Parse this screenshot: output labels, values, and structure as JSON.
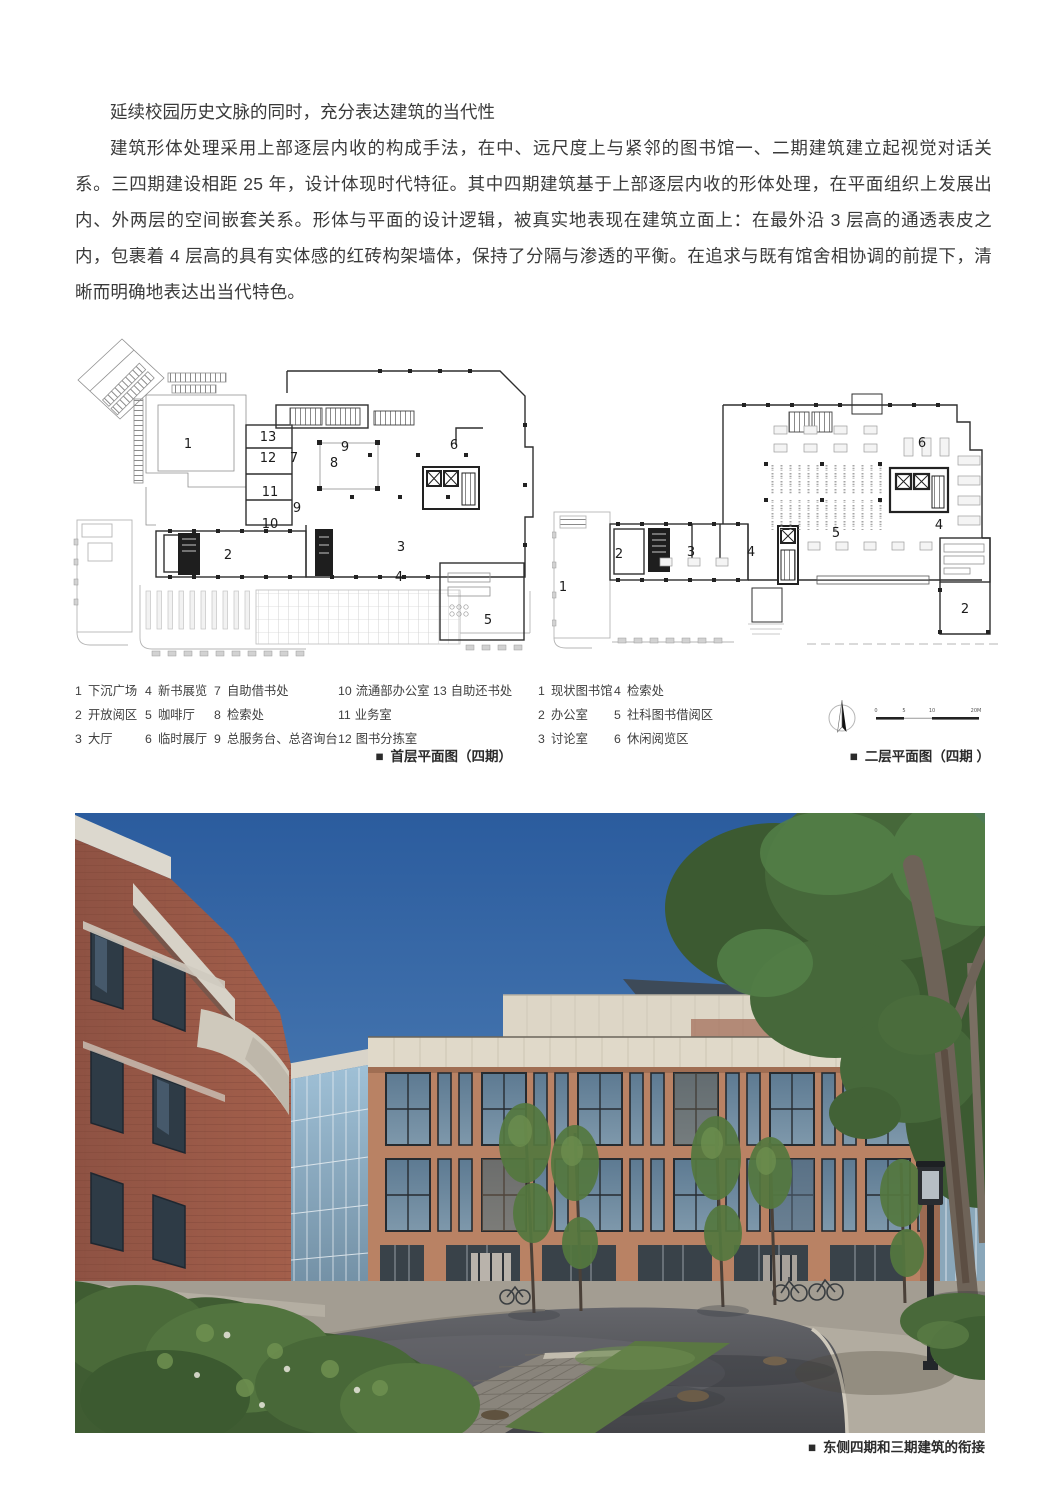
{
  "article": {
    "heading": "延续校园历史文脉的同时，充分表达建筑的当代性",
    "paragraph": "建筑形体处理采用上部逐层内收的构成手法，在中、远尺度上与紧邻的图书馆一、二期建筑建立起视觉对话关系。三四期建设相距 25 年，设计体现时代特征。其中四期建筑基于上部逐层内收的形体处理，在平面组织上发展出内、外两层的空间嵌套关系。形体与平面的设计逻辑，被真实地表现在建筑立面上：在最外沿 3 层高的通透表皮之内，包裹着 4 层高的具有实体感的红砖构架墙体，保持了分隔与渗透的平衡。在追求与既有馆舍相协调的前提下，清晰而明确地表达出当代特色。"
  },
  "first_floor_plan": {
    "caption_marker": "■",
    "caption": "首层平面图（四期）",
    "room_marks": [
      "1",
      "13",
      "12",
      "7",
      "9",
      "8",
      "6",
      "11",
      "9",
      "10",
      "2",
      "3",
      "4",
      "5"
    ],
    "legend": [
      [
        {
          "n": "1",
          "t": "下沉广场"
        },
        {
          "n": "2",
          "t": "开放阅区"
        },
        {
          "n": "3",
          "t": "大厅"
        }
      ],
      [
        {
          "n": "4",
          "t": "新书展览"
        },
        {
          "n": "5",
          "t": "咖啡厅"
        },
        {
          "n": "6",
          "t": "临时展厅"
        }
      ],
      [
        {
          "n": "7",
          "t": "自助借书处"
        },
        {
          "n": "8",
          "t": "检索处"
        },
        {
          "n": "9",
          "t": "总服务台、总咨询台"
        }
      ],
      [
        {
          "n": "10",
          "t": "流通部办公室"
        },
        {
          "n": "11",
          "t": "业务室"
        },
        {
          "n": "12",
          "t": "图书分拣室"
        }
      ],
      [
        {
          "n": "13",
          "t": "自助还书处"
        }
      ]
    ]
  },
  "second_floor_plan": {
    "caption_marker": "■",
    "caption": "二层平面图（四期 ）",
    "room_marks": [
      "6",
      "2",
      "3",
      "4",
      "5",
      "4",
      "1",
      "2"
    ],
    "legend": [
      [
        {
          "n": "1",
          "t": "现状图书馆"
        },
        {
          "n": "2",
          "t": "办公室"
        },
        {
          "n": "3",
          "t": "讨论室"
        }
      ],
      [
        {
          "n": "4",
          "t": "检索处"
        },
        {
          "n": "5",
          "t": "社科图书借阅区"
        },
        {
          "n": "6",
          "t": "休闲阅览区"
        }
      ]
    ]
  },
  "scale_bar": {
    "ticks": [
      "0",
      "5",
      "10",
      "20M"
    ]
  },
  "photo": {
    "caption_marker": "■",
    "caption": "东侧四期和三期建筑的衔接"
  },
  "colors": {
    "brick": "#9a5a48",
    "terracotta": "#b98264",
    "cream_stone": "#ddd6c6",
    "sky_top": "#2b5c9e",
    "foliage": "#46683a"
  }
}
